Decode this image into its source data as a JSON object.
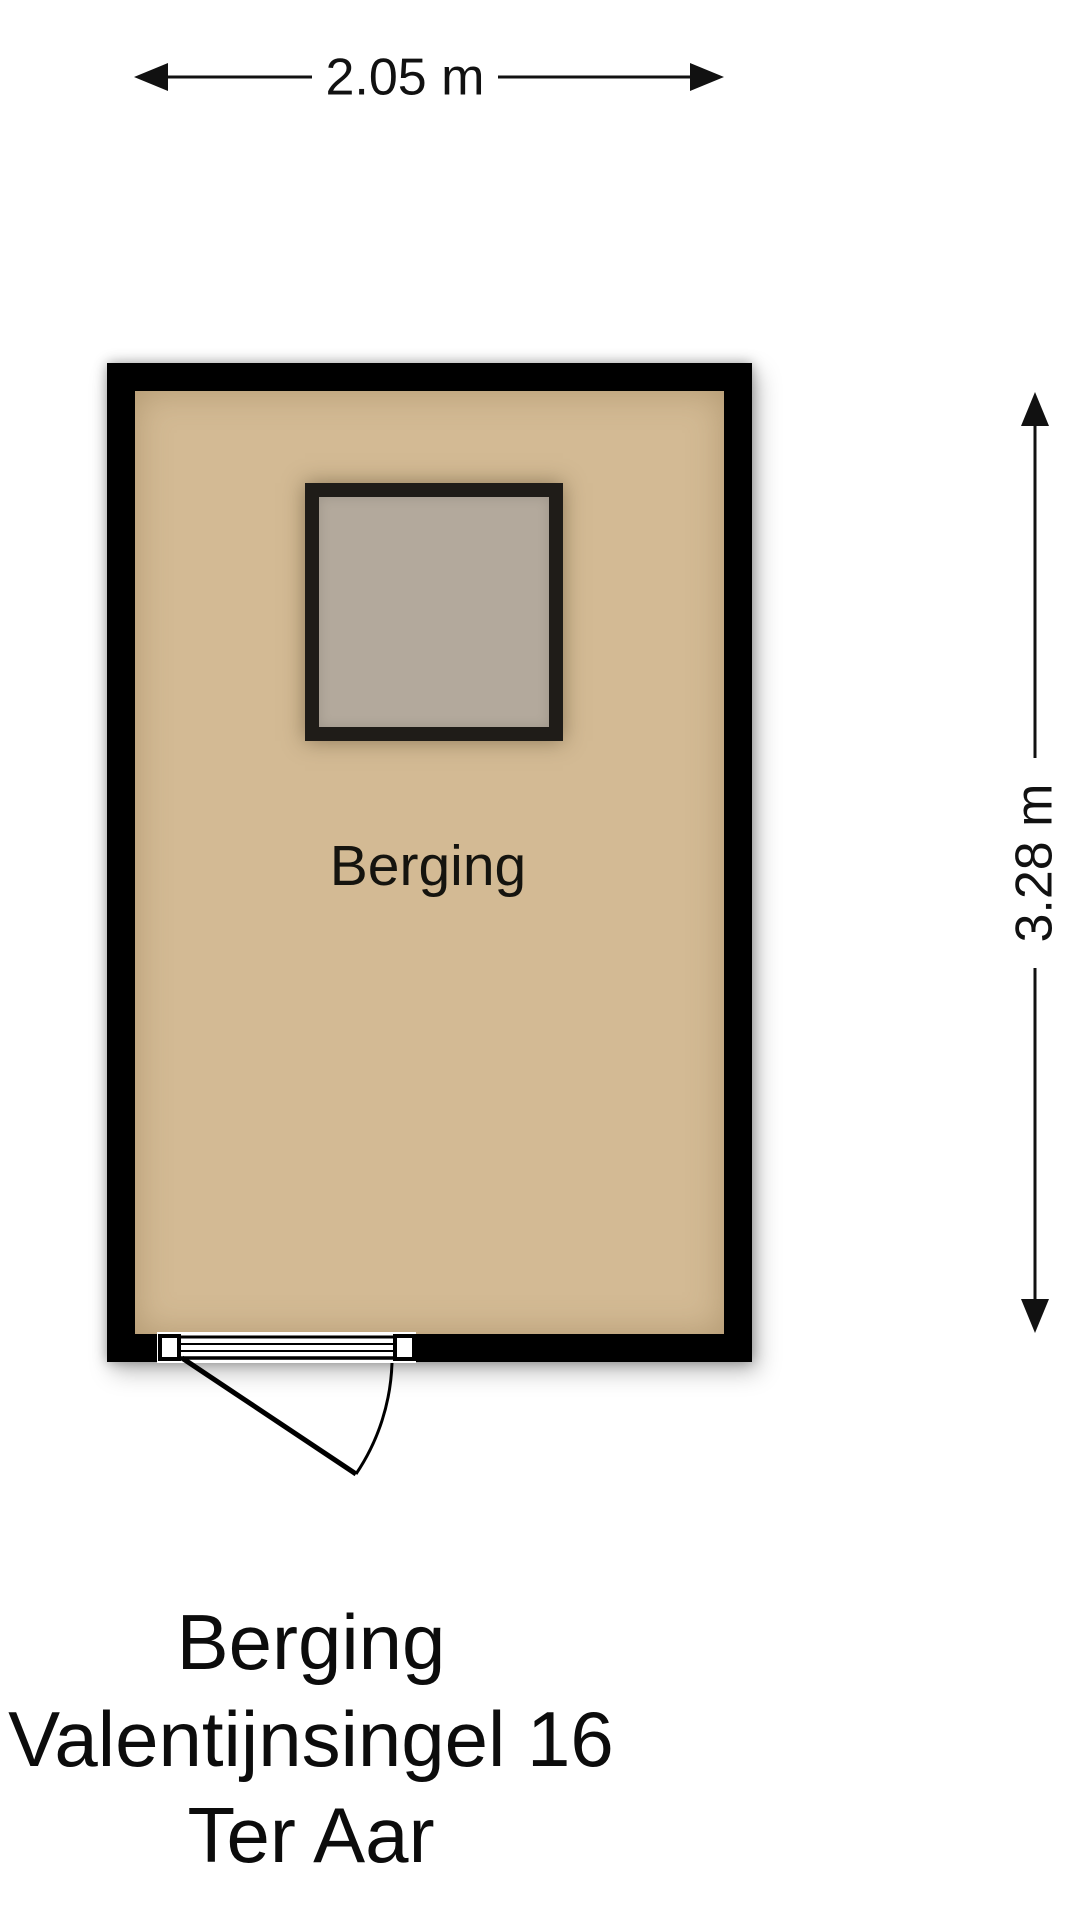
{
  "dimensions": {
    "width_label": "2.05 m",
    "height_label": "3.28 m"
  },
  "room": {
    "label": "Berging",
    "floor_color": "#d3ba94",
    "wall_color": "#000000",
    "fixture_fill_color": "#b3a99c",
    "fixture_frame_color": "#1f1c18"
  },
  "title": {
    "line1": "Berging",
    "line2": "Valentijnsingel 16",
    "line3": "Ter Aar"
  },
  "background_color": "#ffffff",
  "line_color": "#111111"
}
